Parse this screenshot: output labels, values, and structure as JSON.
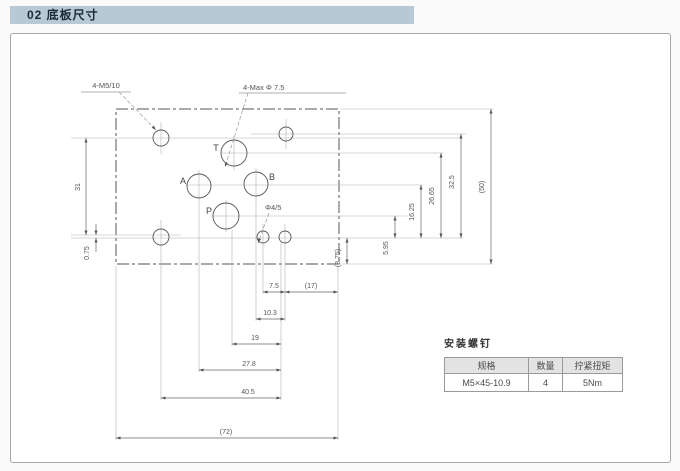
{
  "header": {
    "title": "02 底板尺寸",
    "bg_color": "#b7c9d4"
  },
  "drawing": {
    "callouts": {
      "mounting_holes": "4-M5/10",
      "main_ports": "4-Max Φ 7.5",
      "pin_holes": "Φ4/5"
    },
    "port_labels": {
      "t": "T",
      "a": "A",
      "b": "B",
      "p": "P"
    },
    "dims": {
      "v31": "31",
      "v075": "0.75",
      "v595": "5.95",
      "v1625": "16.25",
      "v2665": "26.65",
      "v325": "32.5",
      "v50": "(50)",
      "v875": "(8.75)",
      "h75": "7.5",
      "h17": "(17)",
      "h103": "10.3",
      "h19": "19",
      "h278": "27.8",
      "h405": "40.5",
      "h72": "(72)"
    }
  },
  "screws_table": {
    "title": "安装螺钉",
    "headers": [
      "规格",
      "数量",
      "拧紧扭矩"
    ],
    "row": [
      "M5×45-10.9",
      "4",
      "5Nm"
    ]
  }
}
